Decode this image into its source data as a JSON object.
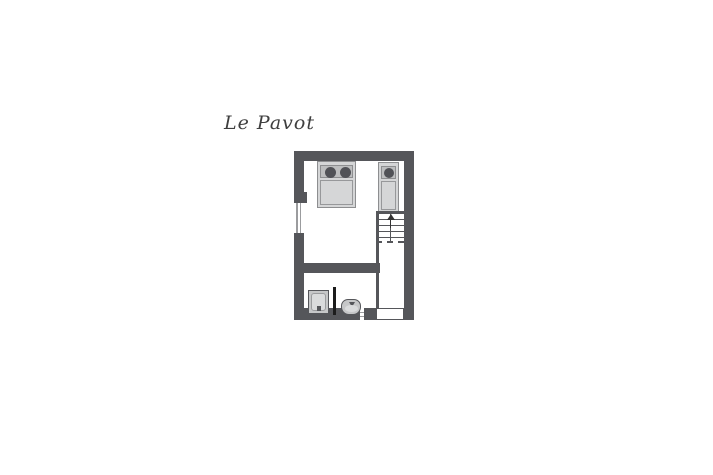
{
  "title": "Le Pavot",
  "colors": {
    "background": "#ffffff",
    "wall": "#55565a",
    "bed_fill": "#d5d6d7",
    "bed_band": "#bdbebf",
    "bed_border": "#8d8e90",
    "pillow": "#515257",
    "fixture_fill": "#c6c7c8",
    "fixture_inner": "#dadbdc",
    "line": "#55565a",
    "screen": "#1c1c1c",
    "window_line": "#9b9c9e",
    "text": "#3f3f3f"
  },
  "floorplan": {
    "elements": [
      "double-bed",
      "single-bed",
      "staircase-up",
      "left-window",
      "bottom-small-window",
      "entry-door-opening",
      "interior-wall",
      "bathroom-partition",
      "glass-screen",
      "shower",
      "washbasin"
    ]
  }
}
